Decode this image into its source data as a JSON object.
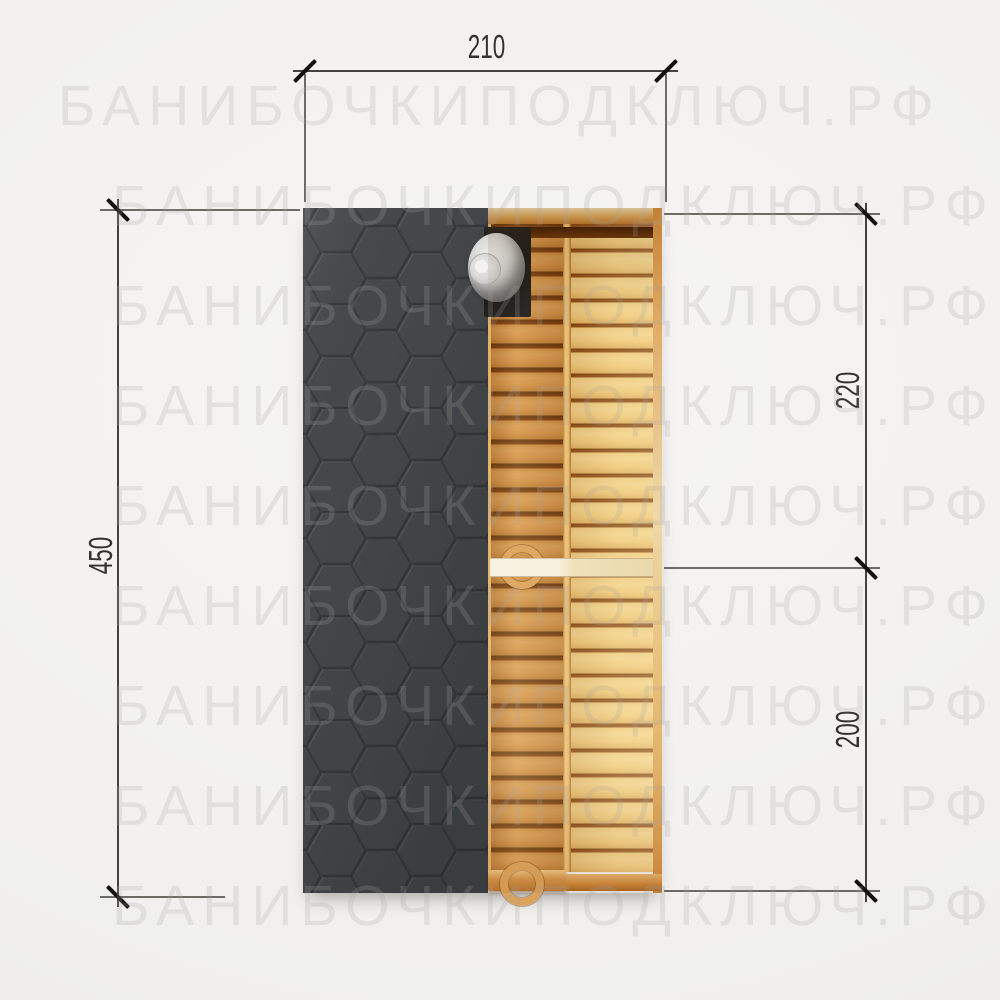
{
  "watermark": {
    "text": "БАНИБОЧКИПОДКЛЮЧ.РФ"
  },
  "dimensions": {
    "width_top": "210",
    "height_left": "450",
    "right_upper": "220",
    "right_lower": "200"
  },
  "colors": {
    "bg": "#f2f1ef",
    "bg_light": "#f6f5f3",
    "bg_dark": "#ececea",
    "roof": "#45484b",
    "roof_line": "#35383b",
    "stove": "#1e1d1a",
    "handle": "#dca35a",
    "dim_line": "#45433f",
    "ext_line": "#6e6b66",
    "tick": "#14120f",
    "dim_text": "#34322f",
    "watermark": "rgba(168,164,159,0.22)"
  }
}
